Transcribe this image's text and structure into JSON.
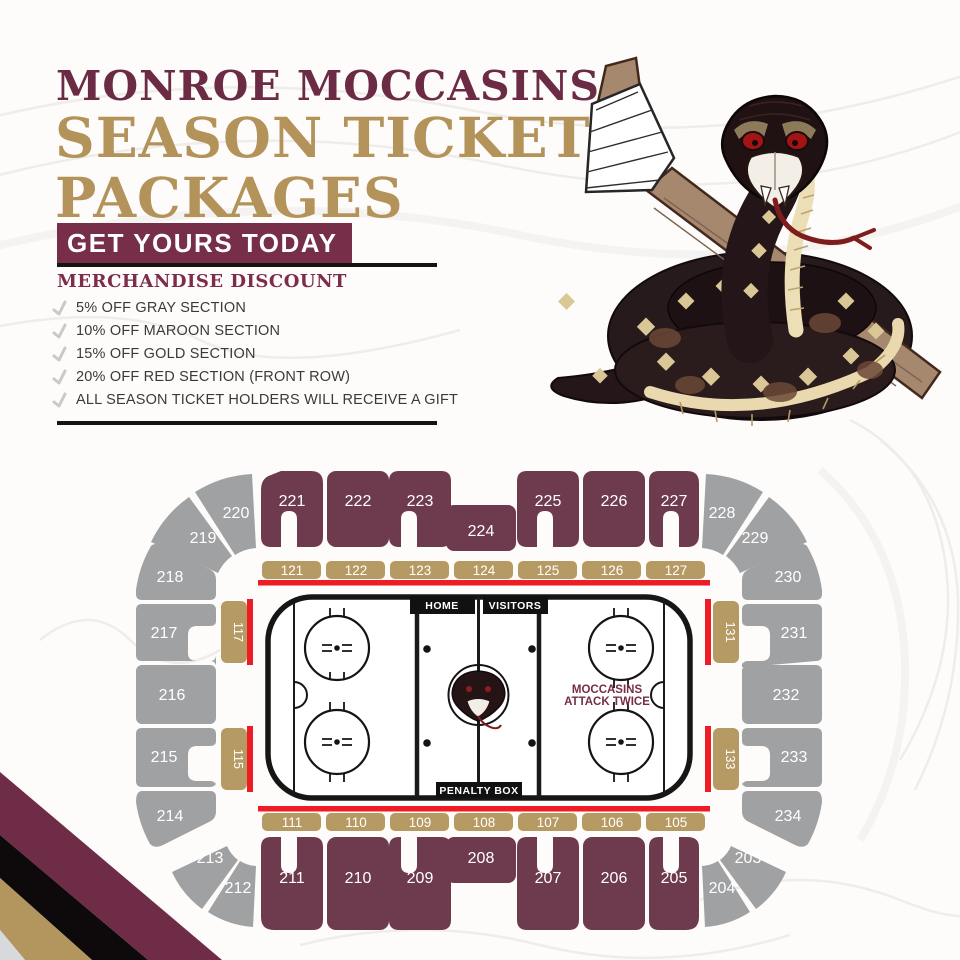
{
  "header": {
    "team": "MONROE MOCCASINS",
    "title_line1": "SEASON TICKET",
    "title_line2": "PACKAGES",
    "cta": "GET YOURS TODAY"
  },
  "discount": {
    "heading": "MERCHANDISE DISCOUNT",
    "items": [
      "5% OFF GRAY SECTION",
      "10% OFF MAROON SECTION",
      "15% OFF GOLD SECTION",
      "20% OFF RED SECTION (FRONT ROW)",
      "ALL SEASON TICKET HOLDERS WILL RECEIVE A GIFT"
    ]
  },
  "rink": {
    "home": "HOME",
    "visitors": "VISITORS",
    "penalty_box": "PENALTY BOX",
    "slogan_line1": "MOCCASINS",
    "slogan_line2": "ATTACK TWICE"
  },
  "sections": {
    "maroon_top": [
      "221",
      "222",
      "223",
      "224",
      "225",
      "226",
      "227"
    ],
    "maroon_bottom": [
      "211",
      "210",
      "209",
      "208",
      "207",
      "206",
      "205"
    ],
    "gold_top": [
      "121",
      "122",
      "123",
      "124",
      "125",
      "126",
      "127"
    ],
    "gold_bottom": [
      "111",
      "110",
      "109",
      "108",
      "107",
      "106",
      "105"
    ],
    "gold_left": [
      "117",
      "115"
    ],
    "gold_right": [
      "131",
      "133"
    ],
    "gray_left": [
      "220",
      "219",
      "218",
      "217",
      "216",
      "215",
      "214",
      "213",
      "212"
    ],
    "gray_right": [
      "228",
      "229",
      "230",
      "231",
      "232",
      "233",
      "234",
      "203",
      "204"
    ]
  },
  "icons": {
    "bullet": "hockey-stick-check",
    "mascot": "snake-with-hockey-stick"
  },
  "colors": {
    "maroon_section": "#6e3a4e",
    "maroon_title": "#6b2b44",
    "gold": "#b59a63",
    "gray_section": "#9fa1a3",
    "front_row_red": "#ee1c24",
    "black": "#141414"
  }
}
